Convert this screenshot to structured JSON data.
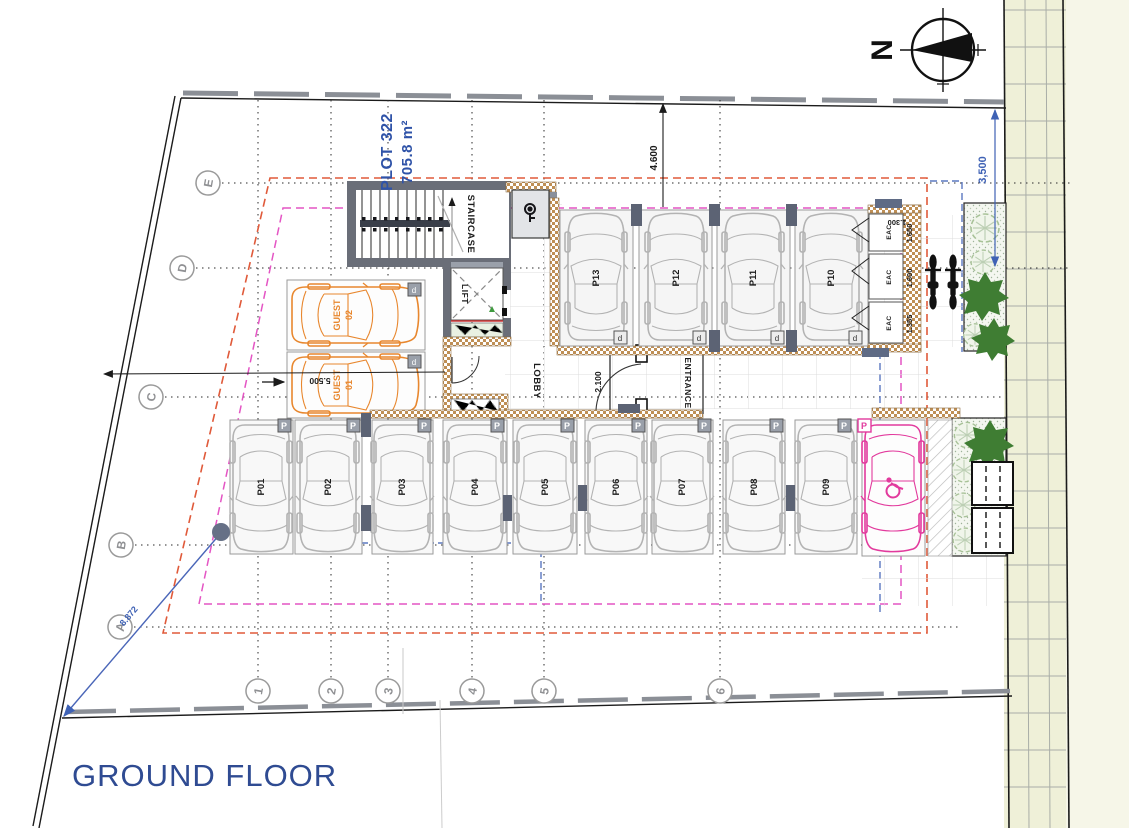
{
  "title": {
    "text": "GROUND FLOOR"
  },
  "plot": {
    "name": "PLOT 322",
    "area": "705.8 m²"
  },
  "north": {
    "letter": "N"
  },
  "grid": {
    "rows": [
      {
        "label": "E"
      },
      {
        "label": "D"
      },
      {
        "label": "C"
      },
      {
        "label": "B"
      },
      {
        "label": "A"
      }
    ],
    "cols": [
      {
        "label": "1"
      },
      {
        "label": "2"
      },
      {
        "label": "3"
      },
      {
        "label": "4"
      },
      {
        "label": "5"
      },
      {
        "label": "6"
      }
    ]
  },
  "rooms": {
    "staircase": "STAIRCASE",
    "lift": "LIFT",
    "lobby": "LOBBY",
    "entrance": "ENTRANCE",
    "eac": [
      {
        "label": "EAC"
      },
      {
        "label": "EAC"
      },
      {
        "label": "EAC"
      }
    ]
  },
  "parking": {
    "symbol": "P",
    "end_symbol": "d",
    "upper": [
      {
        "label": "P13"
      },
      {
        "label": "P12"
      },
      {
        "label": "P11"
      },
      {
        "label": "P10"
      }
    ],
    "lower": [
      {
        "label": "P01"
      },
      {
        "label": "P02"
      },
      {
        "label": "P03"
      },
      {
        "label": "P04"
      },
      {
        "label": "P05"
      },
      {
        "label": "P06"
      },
      {
        "label": "P07"
      },
      {
        "label": "P08"
      },
      {
        "label": "P09"
      }
    ],
    "guest": [
      {
        "line1": "GUEST",
        "line2": "02"
      },
      {
        "line1": "GUEST",
        "line2": "01"
      }
    ]
  },
  "dimensions": {
    "top": "4.600",
    "right": "3,500",
    "left": "5.500",
    "corridor": "2.100",
    "diagonal": "8.872",
    "eac_width": "1.300",
    "eac_room1": "1.650",
    "eac_room2": "1.600",
    "eac_room3": "1.355"
  },
  "colors": {
    "title_blue": "#2F4B92",
    "dim_blue": "#3F62B5",
    "guest_orange": "#E8872E",
    "accessible_pink": "#E23A9D",
    "setback_red": "#E05A3A",
    "setback_magenta": "#E455C4",
    "outline_blue_dash": "#5B78C0",
    "wall_gray": "#6A6E78",
    "wall_hatch_tan": "#BF8F55",
    "pavement_strip": "#EFF0D8",
    "planting_dark_green": "#3F7D33",
    "planting_light_green": "#A8C298"
  }
}
